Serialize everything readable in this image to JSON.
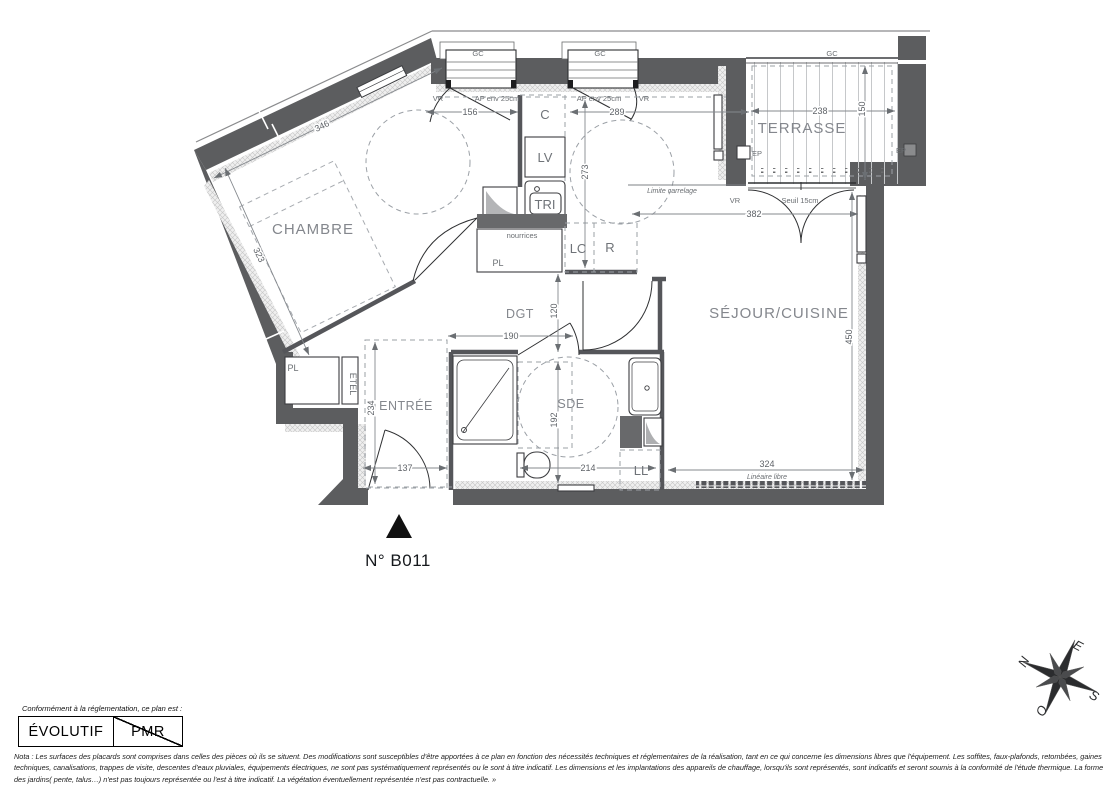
{
  "unit_label": "N° B011",
  "rooms": {
    "chambre": "CHAMBRE",
    "sejour": "SÉJOUR/CUISINE",
    "terrasse": "TERRASSE",
    "entree": "ENTRÉE",
    "sde": "SDE",
    "dgt": "DGT"
  },
  "dims": {
    "d346": "346",
    "d323": "323",
    "d156": "156",
    "d289": "289",
    "d273": "273",
    "d238": "238",
    "d150": "150",
    "d382": "382",
    "d450": "450",
    "d190": "190",
    "d120": "120",
    "d234": "234",
    "d137": "137",
    "d192": "192",
    "d214": "214",
    "d324": "324"
  },
  "annotations": {
    "gc": "GC",
    "vr": "VR",
    "ap_env": "AP env 25cm",
    "seuil": "Seuil 15cm",
    "limite_carrelage": "Limite carrelage",
    "lineaire_libre": "Linéaire libre",
    "nourrices": "nourrices",
    "ep": "EP"
  },
  "fixtures": {
    "c": "C",
    "lv": "LV",
    "tri": "TRI",
    "lc": "LC",
    "r": "R",
    "ll": "LL",
    "pl": "PL",
    "etel": "ETEL"
  },
  "legend": {
    "intro": "Conformément à la réglementation, ce plan est :",
    "option_evolutif": "ÉVOLUTIF",
    "option_pmr": "PMR"
  },
  "compass": {
    "north": "N",
    "east": "E",
    "south": "S",
    "west": "O"
  },
  "nota": "Nota : Les surfaces des placards sont comprises dans celles des pièces où ils se situent. Des modifications sont susceptibles d'être apportées à ce plan en fonction des nécessités techniques et réglementaires de la réalisation, tant en ce qui concerne les dimensions libres que l'équipement.  Les soffites, faux-plafonds, retombées, gaines techniques, canalisations, trappes de visite, descentes d'eaux pluviales, équipements électriques, ne sont pas systématiquement représentés ou le sont à titre indicatif. Les dimensions et les implantations des appareils de chauffage, lorsqu'ils sont représentés, sont indicatifs et seront soumis à la conformité de l'étude thermique. La forme des jardins( pente, talus…) n'est pas toujours représentée ou l'est à titre indicatif. La végétation éventuellement représentée n'est pas contractuelle. »"
}
